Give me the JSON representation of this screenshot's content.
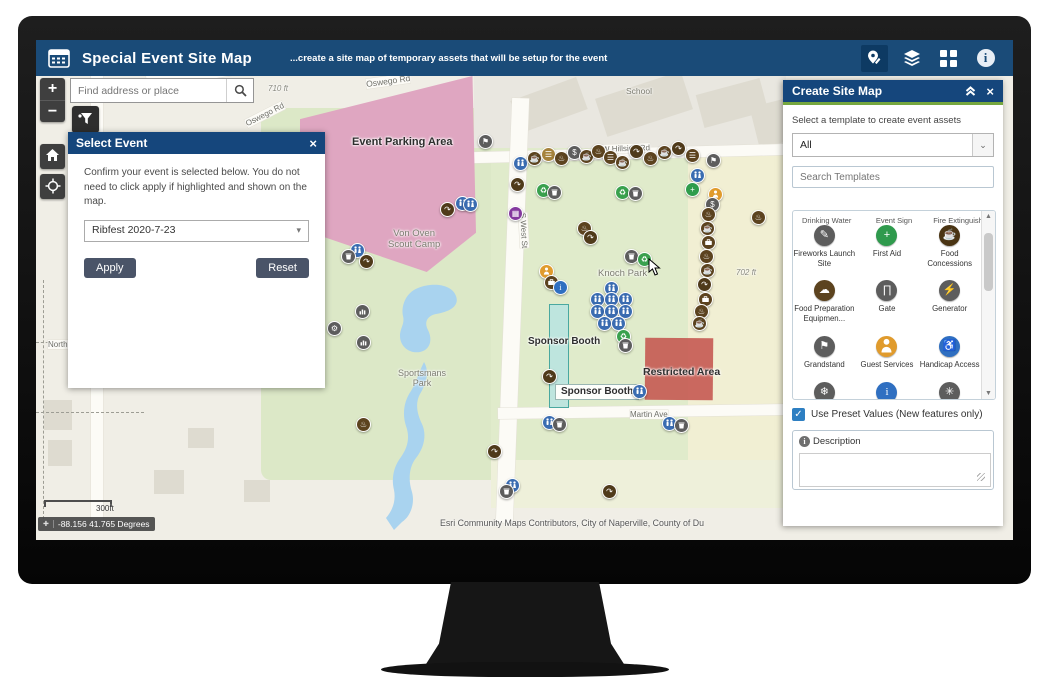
{
  "header": {
    "title": "Special Event Site Map",
    "subtitle": "...create a site map of temporary assets that will be setup for the event"
  },
  "search": {
    "placeholder": "Find address or place"
  },
  "map_controls": {
    "zoom_in": "+",
    "zoom_out": "−"
  },
  "select_event": {
    "title": "Select Event",
    "close": "×",
    "body": "Confirm your event is selected below. You do not need to click apply if highlighted and shown on the map.",
    "dropdown_value": "Ribfest 2020-7-23",
    "apply": "Apply",
    "reset": "Reset"
  },
  "create_panel": {
    "title": "Create Site Map",
    "close": "×",
    "subtitle": "Select a template to create event assets",
    "filter_value": "All",
    "search_placeholder": "Search Templates",
    "templates_partial": [
      "Drinking Water",
      "Event Sign",
      "Fire Extinguisher"
    ],
    "templates": [
      {
        "label": "Fireworks Launch Site",
        "color": "#5d5d5d",
        "glyph": "pencil"
      },
      {
        "label": "First Aid",
        "color": "#2f9a4d",
        "glyph": "plus"
      },
      {
        "label": "Food Concessions",
        "color": "#4a3413",
        "glyph": "coffee"
      },
      {
        "label": "Food Preparation Equipmen...",
        "color": "#5c431f",
        "glyph": "hat"
      },
      {
        "label": "Gate",
        "color": "#5d5d5d",
        "glyph": "gate"
      },
      {
        "label": "Generator",
        "color": "#5d5d5d",
        "glyph": "power"
      },
      {
        "label": "Grandstand",
        "color": "#5d5d5d",
        "glyph": "flag"
      },
      {
        "label": "Guest Services",
        "color": "#e09b2d",
        "glyph": "person"
      },
      {
        "label": "Handicap Access",
        "color": "#2f6fc1",
        "glyph": "handicap"
      },
      {
        "label": "Heater - Cooler",
        "color": "#5d5d5d",
        "glyph": "snow"
      },
      {
        "label": "Information Kiosk",
        "color": "#2f6fc1",
        "glyph": "info"
      },
      {
        "label": "Laser Light",
        "color": "#5d5d5d",
        "glyph": "star"
      }
    ],
    "preset_label": "Use Preset Values (New features only)",
    "description_label": "Description"
  },
  "map": {
    "attribution": "Esri Community Maps Contributors, City of Naperville, County of Du",
    "scale_label": "300ft",
    "coordinates": "-88.156 41.765 Degrees",
    "labels": [
      {
        "text": "Oswego Rd",
        "x": 330,
        "y": 36,
        "size": 8.5,
        "rot": -8,
        "cls": "road"
      },
      {
        "text": "Oswego Rd",
        "x": 208,
        "y": 70,
        "size": 8,
        "rot": -27,
        "cls": "road"
      },
      {
        "text": "710 ft",
        "x": 232,
        "y": 44,
        "size": 8,
        "rot": 0,
        "cls": "elev"
      },
      {
        "text": "School",
        "x": 590,
        "y": 46,
        "size": 8.5,
        "rot": 0,
        "cls": "place"
      },
      {
        "text": "W Hillside Rd",
        "x": 566,
        "y": 104,
        "size": 8,
        "rot": -2,
        "cls": "road"
      },
      {
        "text": "S West St",
        "x": 470,
        "y": 186,
        "size": 8,
        "rot": 87,
        "cls": "road"
      },
      {
        "text": "Von Oven\nScout Camp",
        "x": 352,
        "y": 188,
        "size": 9.5,
        "rot": 0,
        "cls": "place"
      },
      {
        "text": "Knoch Park",
        "x": 562,
        "y": 228,
        "size": 9.5,
        "rot": 0,
        "cls": "place"
      },
      {
        "text": "702 ft",
        "x": 700,
        "y": 228,
        "size": 8,
        "rot": 0,
        "cls": "elev"
      },
      {
        "text": "Sportsmans\nPark",
        "x": 362,
        "y": 328,
        "size": 9,
        "rot": 0,
        "cls": "place"
      },
      {
        "text": "Martin Ave",
        "x": 594,
        "y": 370,
        "size": 8,
        "rot": 0,
        "cls": "road"
      },
      {
        "text": "North",
        "x": 12,
        "y": 300,
        "size": 8,
        "rot": 0,
        "cls": "road"
      },
      {
        "text": "Event Parking Area",
        "x": 316,
        "y": 96,
        "size": 11,
        "rot": 0,
        "cls": "feature"
      },
      {
        "text": "Restricted Area",
        "x": 607,
        "y": 326,
        "size": 10.5,
        "rot": 0,
        "cls": "feature"
      },
      {
        "text": "Sponsor Booth",
        "x": 492,
        "y": 296,
        "size": 10,
        "rot": 0,
        "cls": "feature"
      },
      {
        "text": "Sponsor Booth",
        "x": 519,
        "y": 344,
        "size": 10,
        "rot": 0,
        "cls": "feature boxed"
      }
    ],
    "marker_types": {
      "wc": {
        "color": "#3a6cb1",
        "glyph": "restroom"
      },
      "trash": {
        "color": "#5d5d5d",
        "glyph": "trash"
      },
      "coffee": {
        "color": "#5c431f",
        "glyph": "coffee"
      },
      "burger": {
        "color": "#5c431f",
        "glyph": "burger"
      },
      "tanburger": {
        "color": "#a5823c",
        "glyph": "burger"
      },
      "hot": {
        "color": "#5c431f",
        "glyph": "hotfood"
      },
      "arrow": {
        "color": "#4f3a1a",
        "glyph": "direction"
      },
      "case": {
        "color": "#5c431f",
        "glyph": "vendor-case"
      },
      "dollar": {
        "color": "#5d5d5d",
        "glyph": "dollar"
      },
      "flag": {
        "color": "#5d5d5d",
        "glyph": "flag"
      },
      "plus": {
        "color": "#2e9c4b",
        "glyph": "first-aid"
      },
      "recycle": {
        "color": "#3aa14e",
        "glyph": "recycle"
      },
      "info": {
        "color": "#2f6fc1",
        "glyph": "info"
      },
      "person": {
        "color": "#e09b2d",
        "glyph": "person"
      },
      "grid": {
        "color": "#84399e",
        "glyph": "transit-grid"
      },
      "bars": {
        "color": "#5d5d5d",
        "glyph": "bars"
      },
      "gray": {
        "color": "#5d5d5d",
        "glyph": "gear"
      }
    },
    "markers": [
      [
        448,
        100,
        "flag"
      ],
      [
        483,
        122,
        "wc"
      ],
      [
        497,
        117,
        "coffee"
      ],
      [
        511,
        113,
        "tanburger"
      ],
      [
        524,
        117,
        "hot"
      ],
      [
        537,
        111,
        "dollar"
      ],
      [
        549,
        115,
        "coffee"
      ],
      [
        561,
        110,
        "hot"
      ],
      [
        573,
        116,
        "burger"
      ],
      [
        585,
        121,
        "coffee"
      ],
      [
        599,
        110,
        "arrow"
      ],
      [
        613,
        117,
        "hot"
      ],
      [
        627,
        111,
        "coffee"
      ],
      [
        641,
        107,
        "arrow"
      ],
      [
        655,
        114,
        "burger"
      ],
      [
        676,
        119,
        "flag"
      ],
      [
        660,
        134,
        "wc"
      ],
      [
        655,
        148,
        "plus"
      ],
      [
        678,
        153,
        "person"
      ],
      [
        675,
        163,
        "dollar"
      ],
      [
        671,
        173,
        "hot"
      ],
      [
        670,
        187,
        "coffee"
      ],
      [
        671,
        201,
        "case"
      ],
      [
        669,
        215,
        "hot"
      ],
      [
        670,
        229,
        "coffee"
      ],
      [
        667,
        243,
        "arrow"
      ],
      [
        668,
        258,
        "case"
      ],
      [
        664,
        270,
        "hot"
      ],
      [
        662,
        282,
        "coffee"
      ],
      [
        721,
        176,
        "hot"
      ],
      [
        574,
        247,
        "wc"
      ],
      [
        560,
        258,
        "wc"
      ],
      [
        574,
        258,
        "wc"
      ],
      [
        588,
        258,
        "wc"
      ],
      [
        560,
        270,
        "wc"
      ],
      [
        574,
        270,
        "wc"
      ],
      [
        588,
        270,
        "wc"
      ],
      [
        567,
        282,
        "wc"
      ],
      [
        581,
        282,
        "wc"
      ],
      [
        585,
        151,
        "recycle"
      ],
      [
        598,
        152,
        "trash"
      ],
      [
        594,
        215,
        "trash"
      ],
      [
        607,
        218,
        "recycle"
      ],
      [
        480,
        143,
        "arrow"
      ],
      [
        506,
        149,
        "recycle"
      ],
      [
        517,
        151,
        "trash"
      ],
      [
        478,
        172,
        "grid"
      ],
      [
        410,
        168,
        "arrow"
      ],
      [
        425,
        162,
        "wc"
      ],
      [
        433,
        163,
        "wc"
      ],
      [
        547,
        187,
        "hot"
      ],
      [
        553,
        196,
        "arrow"
      ],
      [
        509,
        230,
        "person"
      ],
      [
        514,
        241,
        "case"
      ],
      [
        523,
        246,
        "info"
      ],
      [
        320,
        209,
        "wc"
      ],
      [
        311,
        215,
        "trash"
      ],
      [
        329,
        220,
        "arrow"
      ],
      [
        325,
        270,
        "bars"
      ],
      [
        297,
        287,
        "gray"
      ],
      [
        326,
        301,
        "bars"
      ],
      [
        512,
        335,
        "arrow"
      ],
      [
        457,
        410,
        "arrow"
      ],
      [
        475,
        444,
        "wc"
      ],
      [
        469,
        450,
        "trash"
      ],
      [
        326,
        383,
        "hot"
      ],
      [
        572,
        450,
        "arrow"
      ],
      [
        586,
        295,
        "recycle"
      ],
      [
        588,
        304,
        "trash"
      ],
      [
        602,
        350,
        "wc"
      ],
      [
        512,
        381,
        "wc"
      ],
      [
        522,
        383,
        "trash"
      ],
      [
        632,
        382,
        "wc"
      ],
      [
        644,
        384,
        "trash"
      ]
    ]
  }
}
